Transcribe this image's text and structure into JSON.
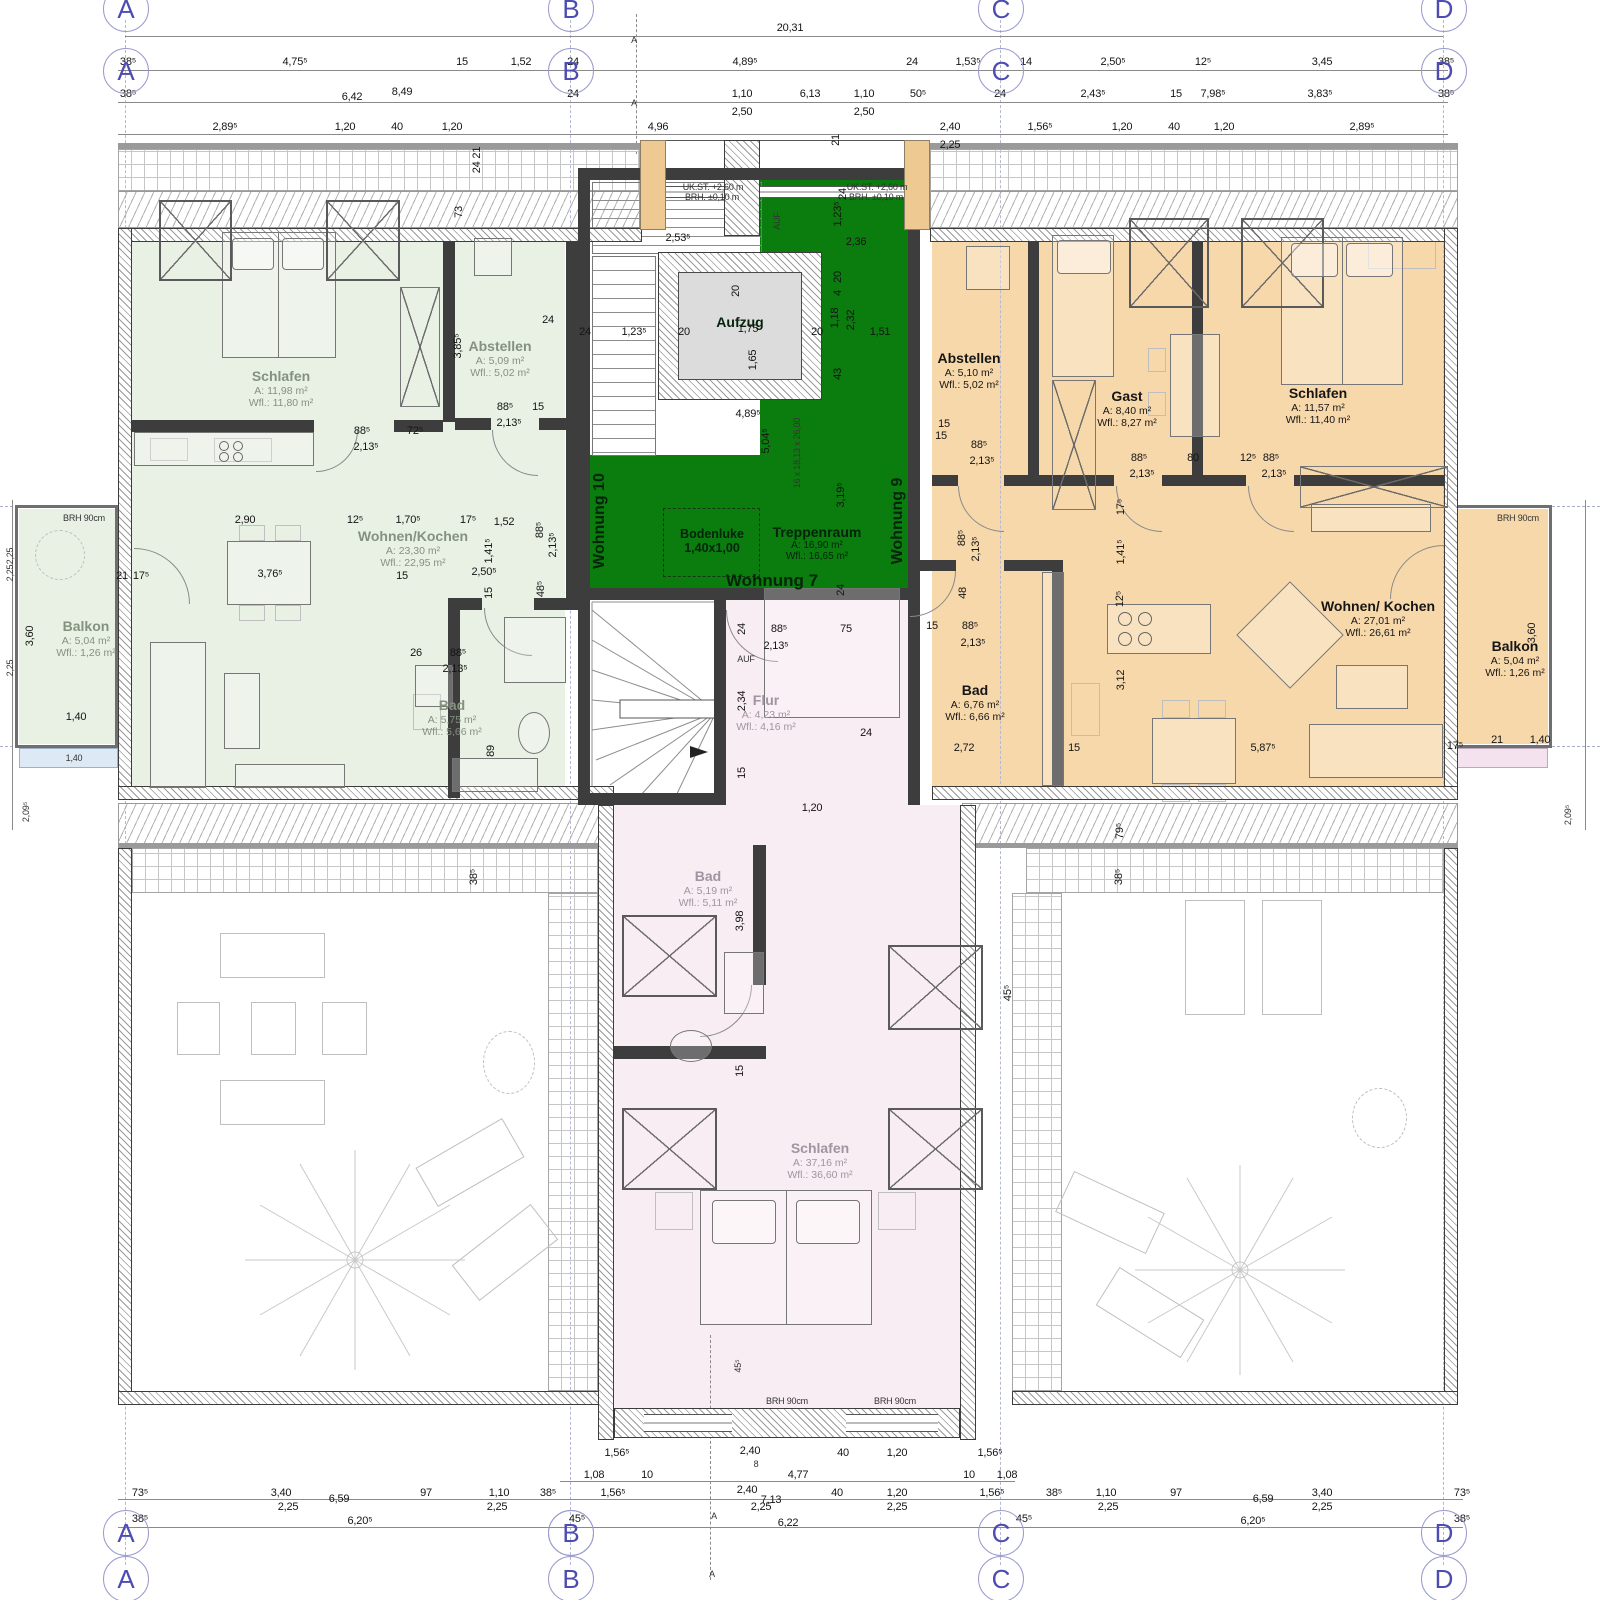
{
  "colors": {
    "green_room": "#e9f1e5",
    "orange_room": "#f7d8ab",
    "pink_room": "#f8edf3",
    "core_green": "#0b7d0e",
    "axis_blue": "#4c4cb2",
    "insulation": "#eeca92"
  },
  "axes": {
    "letters": [
      "A",
      "B",
      "C",
      "D"
    ]
  },
  "overall_width": "20,31",
  "rooms": {
    "l_schlafen": {
      "name": "Schlafen",
      "a": "A:    11,98 m²",
      "wfl": "Wfl.: 11,80 m²"
    },
    "l_abstellen": {
      "name": "Abstellen",
      "a": "A:    5,09 m²",
      "wfl": "Wfl.: 5,02 m²"
    },
    "l_wohnen": {
      "name": "Wohnen/Kochen",
      "a": "A:    23,30 m²",
      "wfl": "Wfl.: 22,95 m²"
    },
    "l_bad": {
      "name": "Bad",
      "a": "A:    5,75 m²",
      "wfl": "Wfl.: 5,66 m²"
    },
    "l_balkon": {
      "name": "Balkon",
      "a": "A:    5,04 m²",
      "wfl": "Wfl.: 1,26 m²"
    },
    "r_abstellen": {
      "name": "Abstellen",
      "a": "A:    5,10 m²",
      "wfl": "Wfl.: 5,02 m²"
    },
    "r_gast": {
      "name": "Gast",
      "a": "A:    8,40 m²",
      "wfl": "Wfl.: 8,27 m²"
    },
    "r_schlafen": {
      "name": "Schlafen",
      "a": "A:    11,57 m²",
      "wfl": "Wfl.: 11,40 m²"
    },
    "r_wohnen": {
      "name": "Wohnen/ Kochen",
      "a": "A:    27,01 m²",
      "wfl": "Wfl.: 26,61 m²"
    },
    "r_bad": {
      "name": "Bad",
      "a": "A:    6,76 m²",
      "wfl": "Wfl.: 6,66 m²"
    },
    "r_balkon": {
      "name": "Balkon",
      "a": "A:    5,04 m²",
      "wfl": "Wfl.: 1,26 m²"
    },
    "treppenraum": {
      "name": "Treppenraum",
      "a": "A:    16,90 m²",
      "wfl": "Wfl.: 16,65 m²"
    },
    "flur": {
      "name": "Flur",
      "a": "A:    4,23 m²",
      "wfl": "Wfl.: 4,16 m²"
    },
    "b_bad": {
      "name": "Bad",
      "a": "A:    5,19 m²",
      "wfl": "Wfl.: 5,11 m²"
    },
    "b_schlafen": {
      "name": "Schlafen",
      "a": "A:    37,16 m²",
      "wfl": "Wfl.: 36,60 m²"
    }
  },
  "core": {
    "aufzug": "Aufzug",
    "bodenluke": "Bodenluke",
    "bodenluke_size": "1,40x1,00",
    "wohnung7": "Wohnung 7",
    "wohnung9": "Wohnung 9",
    "wohnung10": "Wohnung 10",
    "stair_spec": "16 x 18,13 x 26,00",
    "uk_st": "UK.ST.  +2,60 m",
    "brh_st": "BRH.  ±0,10 m",
    "auf": "AUF"
  },
  "annotations": [
    {
      "t": "20,31",
      "x": 790,
      "y": 28
    },
    {
      "t": "38⁵",
      "x": 128,
      "y": 62
    },
    {
      "t": "4,75⁵",
      "x": 295,
      "y": 62
    },
    {
      "t": "15",
      "x": 462,
      "y": 62
    },
    {
      "t": "1,52",
      "x": 521,
      "y": 62
    },
    {
      "t": "24",
      "x": 573,
      "y": 62
    },
    {
      "t": "4,89⁵",
      "x": 745,
      "y": 62
    },
    {
      "t": "24",
      "x": 912,
      "y": 62
    },
    {
      "t": "1,53⁵",
      "x": 968,
      "y": 62
    },
    {
      "t": "14",
      "x": 1026,
      "y": 62
    },
    {
      "t": "2,50⁵",
      "x": 1113,
      "y": 62
    },
    {
      "t": "12⁵",
      "x": 1203,
      "y": 62
    },
    {
      "t": "3,45",
      "x": 1322,
      "y": 62
    },
    {
      "t": "38⁵",
      "x": 1446,
      "y": 62
    },
    {
      "t": "38⁵",
      "x": 128,
      "y": 94
    },
    {
      "t": "6,42",
      "x": 352,
      "y": 97
    },
    {
      "t": "8,49",
      "x": 402,
      "y": 92
    },
    {
      "t": "24",
      "x": 573,
      "y": 94
    },
    {
      "t": "1,10",
      "x": 742,
      "y": 94
    },
    {
      "t": "6,13",
      "x": 810,
      "y": 94
    },
    {
      "t": "1,10",
      "x": 864,
      "y": 94
    },
    {
      "t": "50⁵",
      "x": 918,
      "y": 94
    },
    {
      "t": "24",
      "x": 1000,
      "y": 94
    },
    {
      "t": "2,43⁵",
      "x": 1093,
      "y": 94
    },
    {
      "t": "15",
      "x": 1176,
      "y": 94
    },
    {
      "t": "7,98⁵",
      "x": 1213,
      "y": 94
    },
    {
      "t": "3,83⁵",
      "x": 1320,
      "y": 94
    },
    {
      "t": "38⁵",
      "x": 1446,
      "y": 94
    },
    {
      "t": "2,50",
      "x": 742,
      "y": 112
    },
    {
      "t": "2,50",
      "x": 864,
      "y": 112
    },
    {
      "t": "2,89⁵",
      "x": 225,
      "y": 127
    },
    {
      "t": "1,20",
      "x": 345,
      "y": 127
    },
    {
      "t": "40",
      "x": 397,
      "y": 127
    },
    {
      "t": "1,20",
      "x": 452,
      "y": 127
    },
    {
      "t": "4,96",
      "x": 658,
      "y": 127
    },
    {
      "t": "2,40",
      "x": 950,
      "y": 127
    },
    {
      "t": "1,56⁵",
      "x": 1040,
      "y": 127
    },
    {
      "t": "1,20",
      "x": 1122,
      "y": 127
    },
    {
      "t": "40",
      "x": 1174,
      "y": 127
    },
    {
      "t": "1,20",
      "x": 1224,
      "y": 127
    },
    {
      "t": "2,89⁵",
      "x": 1362,
      "y": 127
    },
    {
      "t": "2,25",
      "x": 950,
      "y": 145
    },
    {
      "t": "24 21",
      "x": 477,
      "y": 160,
      "r": 1
    },
    {
      "t": "73",
      "x": 459,
      "y": 212,
      "r": 1
    },
    {
      "t": "21",
      "x": 836,
      "y": 140,
      "r": 1
    },
    {
      "t": "24",
      "x": 843,
      "y": 194,
      "r": 1
    },
    {
      "t": "UK.ST.  +2,60 m",
      "x": 713,
      "y": 187,
      "s": 1
    },
    {
      "t": "BRH.  ±0,10 m",
      "x": 712,
      "y": 197,
      "s": 1
    },
    {
      "t": "UK.ST.  +2,60 m",
      "x": 877,
      "y": 187,
      "s": 1
    },
    {
      "t": "BRH.  ±0,10 m",
      "x": 876,
      "y": 197,
      "s": 1
    },
    {
      "t": "2,53⁵",
      "x": 678,
      "y": 238
    },
    {
      "t": "24",
      "x": 585,
      "y": 332
    },
    {
      "t": "1,23⁵",
      "x": 634,
      "y": 332
    },
    {
      "t": "20",
      "x": 684,
      "y": 332
    },
    {
      "t": "1,75",
      "x": 748,
      "y": 329
    },
    {
      "t": "20",
      "x": 817,
      "y": 332
    },
    {
      "t": "1,65",
      "x": 753,
      "y": 360,
      "r": 1
    },
    {
      "t": "20",
      "x": 736,
      "y": 291,
      "r": 1
    },
    {
      "t": "AUF",
      "x": 777,
      "y": 221,
      "r": 1,
      "s": 1
    },
    {
      "t": "1,23⁵",
      "x": 838,
      "y": 214,
      "r": 1
    },
    {
      "t": "2,36",
      "x": 856,
      "y": 242
    },
    {
      "t": "20",
      "x": 838,
      "y": 277,
      "r": 1
    },
    {
      "t": "4",
      "x": 838,
      "y": 293,
      "r": 1
    },
    {
      "t": "1,18",
      "x": 835,
      "y": 318,
      "r": 1
    },
    {
      "t": "2,32",
      "x": 851,
      "y": 320,
      "r": 1
    },
    {
      "t": "1,51",
      "x": 880,
      "y": 332
    },
    {
      "t": "43",
      "x": 838,
      "y": 374,
      "r": 1
    },
    {
      "t": "4,89⁵",
      "x": 748,
      "y": 414
    },
    {
      "t": "5,04⁵",
      "x": 766,
      "y": 441,
      "r": 1
    },
    {
      "t": "16 x 18,13 x 26,00",
      "x": 797,
      "y": 453,
      "r": 1,
      "s": 1
    },
    {
      "t": "15",
      "x": 944,
      "y": 424
    },
    {
      "t": "3,19⁵",
      "x": 841,
      "y": 495,
      "r": 1
    },
    {
      "t": "24",
      "x": 841,
      "y": 590,
      "r": 1
    },
    {
      "t": "24",
      "x": 742,
      "y": 629,
      "r": 1
    },
    {
      "t": "88⁵",
      "x": 779,
      "y": 629
    },
    {
      "t": "2,13⁵",
      "x": 776,
      "y": 646
    },
    {
      "t": "75",
      "x": 846,
      "y": 629
    },
    {
      "t": "AUF",
      "x": 746,
      "y": 659,
      "s": 1
    },
    {
      "t": "2,34",
      "x": 742,
      "y": 701,
      "r": 1
    },
    {
      "t": "15",
      "x": 742,
      "y": 773,
      "r": 1
    },
    {
      "t": "24",
      "x": 866,
      "y": 733
    },
    {
      "t": "1,20",
      "x": 812,
      "y": 808
    },
    {
      "t": "88⁵",
      "x": 362,
      "y": 431
    },
    {
      "t": "2,13⁵",
      "x": 366,
      "y": 447
    },
    {
      "t": "72⁵",
      "x": 415,
      "y": 431
    },
    {
      "t": "88⁵",
      "x": 505,
      "y": 407
    },
    {
      "t": "2,13⁵",
      "x": 509,
      "y": 423
    },
    {
      "t": "15",
      "x": 538,
      "y": 407
    },
    {
      "t": "3,85⁵",
      "x": 458,
      "y": 346,
      "r": 1
    },
    {
      "t": "24",
      "x": 548,
      "y": 320
    },
    {
      "t": "2,90",
      "x": 245,
      "y": 520
    },
    {
      "t": "12⁵",
      "x": 355,
      "y": 520
    },
    {
      "t": "1,70⁵",
      "x": 408,
      "y": 520
    },
    {
      "t": "17⁵",
      "x": 468,
      "y": 520
    },
    {
      "t": "1,52",
      "x": 504,
      "y": 522
    },
    {
      "t": "3,76⁵",
      "x": 270,
      "y": 574
    },
    {
      "t": "15",
      "x": 402,
      "y": 576
    },
    {
      "t": "2,50⁵",
      "x": 484,
      "y": 572
    },
    {
      "t": "1,41⁵",
      "x": 489,
      "y": 551,
      "r": 1
    },
    {
      "t": "88⁵",
      "x": 540,
      "y": 530,
      "r": 1
    },
    {
      "t": "2,13⁵",
      "x": 553,
      "y": 545,
      "r": 1
    },
    {
      "t": "15",
      "x": 489,
      "y": 593,
      "r": 1
    },
    {
      "t": "48⁵",
      "x": 541,
      "y": 589,
      "r": 1
    },
    {
      "t": "21",
      "x": 122,
      "y": 576
    },
    {
      "t": "17⁵",
      "x": 141,
      "y": 576
    },
    {
      "t": "26",
      "x": 416,
      "y": 653
    },
    {
      "t": "88⁵",
      "x": 458,
      "y": 653
    },
    {
      "t": "2,13⁵",
      "x": 455,
      "y": 669
    },
    {
      "t": "89",
      "x": 491,
      "y": 751,
      "r": 1
    },
    {
      "t": "BRH 90cm",
      "x": 84,
      "y": 518,
      "s": 1
    },
    {
      "t": "3,60",
      "x": 30,
      "y": 636,
      "r": 1
    },
    {
      "t": "1,40",
      "x": 76,
      "y": 717
    },
    {
      "t": "1,40",
      "x": 74,
      "y": 758,
      "s": 1
    },
    {
      "t": "2,25",
      "x": 10,
      "y": 556,
      "r": 1,
      "s": 1
    },
    {
      "t": "2,25",
      "x": 10,
      "y": 573,
      "r": 1,
      "s": 1
    },
    {
      "t": "2,25",
      "x": 10,
      "y": 668,
      "r": 1,
      "s": 1
    },
    {
      "t": "2,09⁵",
      "x": 26,
      "y": 812,
      "r": 1,
      "s": 1
    },
    {
      "t": "15",
      "x": 941,
      "y": 436
    },
    {
      "t": "88⁵",
      "x": 979,
      "y": 445
    },
    {
      "t": "2,13⁵",
      "x": 982,
      "y": 461
    },
    {
      "t": "88⁵",
      "x": 1139,
      "y": 458
    },
    {
      "t": "2,13⁵",
      "x": 1142,
      "y": 474
    },
    {
      "t": "80",
      "x": 1193,
      "y": 458
    },
    {
      "t": "12⁵",
      "x": 1248,
      "y": 458
    },
    {
      "t": "88⁵",
      "x": 1271,
      "y": 458
    },
    {
      "t": "2,13⁵",
      "x": 1274,
      "y": 474
    },
    {
      "t": "17⁵",
      "x": 1121,
      "y": 507,
      "r": 1
    },
    {
      "t": "1,41⁵",
      "x": 1121,
      "y": 552,
      "r": 1
    },
    {
      "t": "12⁵",
      "x": 1120,
      "y": 599,
      "r": 1
    },
    {
      "t": "88⁵",
      "x": 962,
      "y": 538,
      "r": 1
    },
    {
      "t": "2,13⁵",
      "x": 976,
      "y": 549,
      "r": 1
    },
    {
      "t": "48",
      "x": 963,
      "y": 593,
      "r": 1
    },
    {
      "t": "15",
      "x": 932,
      "y": 626
    },
    {
      "t": "88⁵",
      "x": 970,
      "y": 626
    },
    {
      "t": "2,13⁵",
      "x": 973,
      "y": 643
    },
    {
      "t": "2,72",
      "x": 964,
      "y": 748
    },
    {
      "t": "15",
      "x": 1074,
      "y": 748
    },
    {
      "t": "3,12",
      "x": 1121,
      "y": 680,
      "r": 1
    },
    {
      "t": "5,87⁵",
      "x": 1263,
      "y": 748
    },
    {
      "t": "17⁵",
      "x": 1455,
      "y": 746
    },
    {
      "t": "21",
      "x": 1497,
      "y": 740
    },
    {
      "t": "1,40",
      "x": 1540,
      "y": 740
    },
    {
      "t": "BRH 90cm",
      "x": 1518,
      "y": 518,
      "s": 1
    },
    {
      "t": "3,60",
      "x": 1532,
      "y": 633,
      "r": 1
    },
    {
      "t": "2,09⁵",
      "x": 1568,
      "y": 815,
      "r": 1,
      "s": 1
    },
    {
      "t": "79⁵",
      "x": 1120,
      "y": 831,
      "r": 1
    },
    {
      "t": "38⁵",
      "x": 1119,
      "y": 877,
      "r": 1
    },
    {
      "t": "38⁵",
      "x": 474,
      "y": 877,
      "r": 1
    },
    {
      "t": "45⁵",
      "x": 1008,
      "y": 993,
      "r": 1
    },
    {
      "t": "3,98",
      "x": 740,
      "y": 921,
      "r": 1
    },
    {
      "t": "15",
      "x": 740,
      "y": 1071,
      "r": 1
    },
    {
      "t": "45⁵",
      "x": 738,
      "y": 1366,
      "r": 1,
      "s": 1
    },
    {
      "t": "BRH 90cm",
      "x": 787,
      "y": 1401,
      "s": 1
    },
    {
      "t": "BRH 90cm",
      "x": 895,
      "y": 1401,
      "s": 1
    },
    {
      "t": "1,56⁵",
      "x": 617,
      "y": 1453
    },
    {
      "t": "2,40",
      "x": 750,
      "y": 1451
    },
    {
      "t": "8",
      "x": 756,
      "y": 1464,
      "s": 1
    },
    {
      "t": "40",
      "x": 843,
      "y": 1453
    },
    {
      "t": "1,20",
      "x": 897,
      "y": 1453
    },
    {
      "t": "1,56⁵",
      "x": 990,
      "y": 1453
    },
    {
      "t": "1,08",
      "x": 594,
      "y": 1475
    },
    {
      "t": "10",
      "x": 647,
      "y": 1475
    },
    {
      "t": "4,77",
      "x": 798,
      "y": 1475
    },
    {
      "t": "10",
      "x": 969,
      "y": 1475
    },
    {
      "t": "1,08",
      "x": 1007,
      "y": 1475
    },
    {
      "t": "73⁵",
      "x": 140,
      "y": 1493
    },
    {
      "t": "3,40",
      "x": 281,
      "y": 1493
    },
    {
      "t": "6,59",
      "x": 339,
      "y": 1499
    },
    {
      "t": "97",
      "x": 426,
      "y": 1493
    },
    {
      "t": "1,10",
      "x": 499,
      "y": 1493
    },
    {
      "t": "38⁵",
      "x": 548,
      "y": 1493
    },
    {
      "t": "1,56⁵",
      "x": 613,
      "y": 1493
    },
    {
      "t": "2,40",
      "x": 747,
      "y": 1490
    },
    {
      "t": "7,13",
      "x": 771,
      "y": 1500
    },
    {
      "t": "40",
      "x": 837,
      "y": 1493
    },
    {
      "t": "1,20",
      "x": 897,
      "y": 1493
    },
    {
      "t": "1,56⁵",
      "x": 992,
      "y": 1493
    },
    {
      "t": "38⁵",
      "x": 1054,
      "y": 1493
    },
    {
      "t": "1,10",
      "x": 1106,
      "y": 1493
    },
    {
      "t": "97",
      "x": 1176,
      "y": 1493
    },
    {
      "t": "6,59",
      "x": 1263,
      "y": 1499
    },
    {
      "t": "3,40",
      "x": 1322,
      "y": 1493
    },
    {
      "t": "73⁵",
      "x": 1462,
      "y": 1493
    },
    {
      "t": "2,25",
      "x": 288,
      "y": 1507
    },
    {
      "t": "2,25",
      "x": 497,
      "y": 1507
    },
    {
      "t": "2,25",
      "x": 761,
      "y": 1507
    },
    {
      "t": "2,25",
      "x": 897,
      "y": 1507
    },
    {
      "t": "2,25",
      "x": 1108,
      "y": 1507
    },
    {
      "t": "2,25",
      "x": 1322,
      "y": 1507
    },
    {
      "t": "38⁵",
      "x": 140,
      "y": 1519
    },
    {
      "t": "6,20⁵",
      "x": 360,
      "y": 1521
    },
    {
      "t": "45⁵",
      "x": 577,
      "y": 1519
    },
    {
      "t": "6,22",
      "x": 788,
      "y": 1523
    },
    {
      "t": "45⁵",
      "x": 1024,
      "y": 1519
    },
    {
      "t": "6,20⁵",
      "x": 1253,
      "y": 1521
    },
    {
      "t": "38⁵",
      "x": 1462,
      "y": 1519
    },
    {
      "t": "A",
      "x": 634,
      "y": 40,
      "s": 1
    },
    {
      "t": "A",
      "x": 634,
      "y": 103,
      "s": 1
    },
    {
      "t": "A",
      "x": 714,
      "y": 1516,
      "s": 1
    },
    {
      "t": "A",
      "x": 712,
      "y": 1574,
      "s": 1
    }
  ]
}
